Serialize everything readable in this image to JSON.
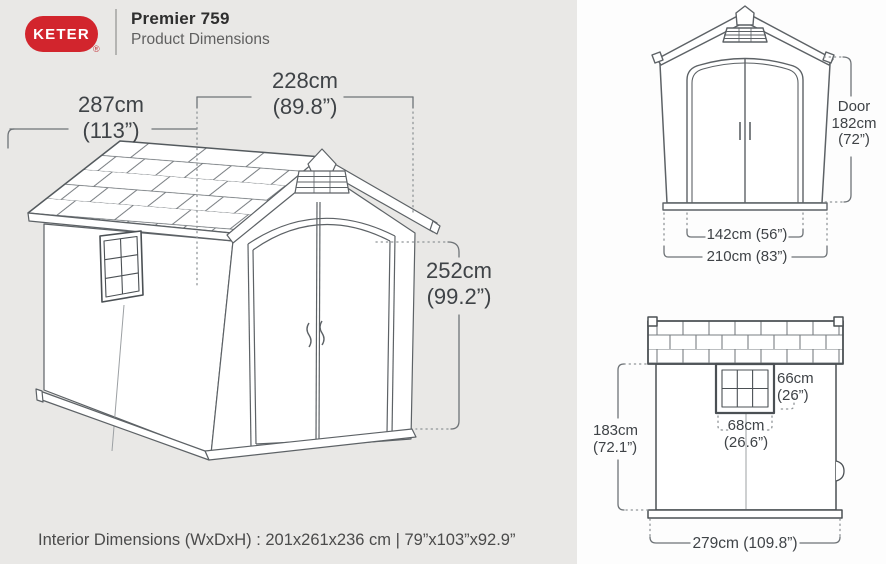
{
  "header": {
    "logo_text": "KETER",
    "registered_mark": "®",
    "title": "Premier 759",
    "subtitle": "Product Dimensions"
  },
  "main_view": {
    "depth_cm": "287cm",
    "depth_in": "(113”)",
    "width_cm": "228cm",
    "width_in": "(89.8”)",
    "height_cm": "252cm",
    "height_in": "(99.2”)"
  },
  "front_view": {
    "door_label": "Door",
    "door_height_cm": "182cm",
    "door_height_in": "(72”)",
    "door_width": "142cm (56”)",
    "total_width": "210cm (83”)"
  },
  "side_view": {
    "window_height_cm": "66cm",
    "window_height_in": "(26”)",
    "window_width_cm": "68cm",
    "window_width_in": "(26.6”)",
    "wall_height_cm": "183cm",
    "wall_height_in": "(72.1”)",
    "total_depth": "279cm (109.8”)"
  },
  "footer": {
    "interior": "Interior Dimensions (WxDxH) : 201x261x236 cm | 79”x103”x92.9”"
  },
  "colors": {
    "brand_red": "#d2252d",
    "panel_left_bg": "#e9e8e6",
    "panel_right_bg": "#fdfdfd",
    "line": "#5d6266",
    "text": "#3f4347"
  }
}
